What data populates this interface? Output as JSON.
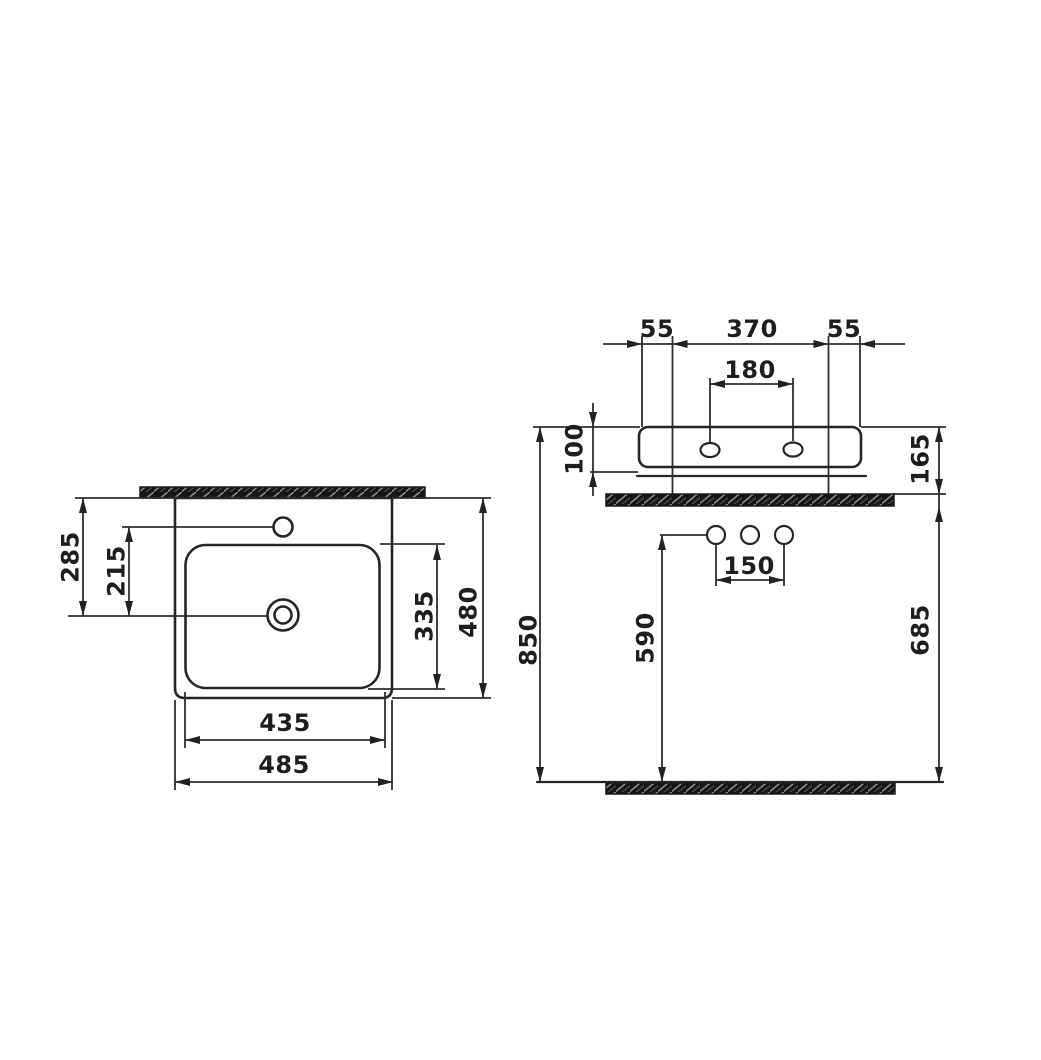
{
  "colors": {
    "line": "#262626",
    "dimension_line": "#2e2e2e",
    "hatch_fill": "#161616",
    "background": "#ffffff"
  },
  "drawing": {
    "kind": "washbasin technical dimension drawing",
    "views": {
      "top_view": "plan view of basin",
      "front_view": "elevation view with wall fixing and floor"
    }
  },
  "dims": {
    "overall_width": "485",
    "basin_width": "435",
    "overall_depth": "480",
    "basin_depth": "335",
    "front_edge_to_drain": "285",
    "faucet_to_drain": "215",
    "back_left_offset": "55",
    "back_center_width": "370",
    "back_right_offset": "55",
    "fixing_hole_spacing": "180",
    "body_height": "100",
    "rim_to_counter": "165",
    "floor_to_rim": "850",
    "floor_to_outlets": "590",
    "floor_to_counter": "685",
    "supply_hole_spacing": "150"
  }
}
